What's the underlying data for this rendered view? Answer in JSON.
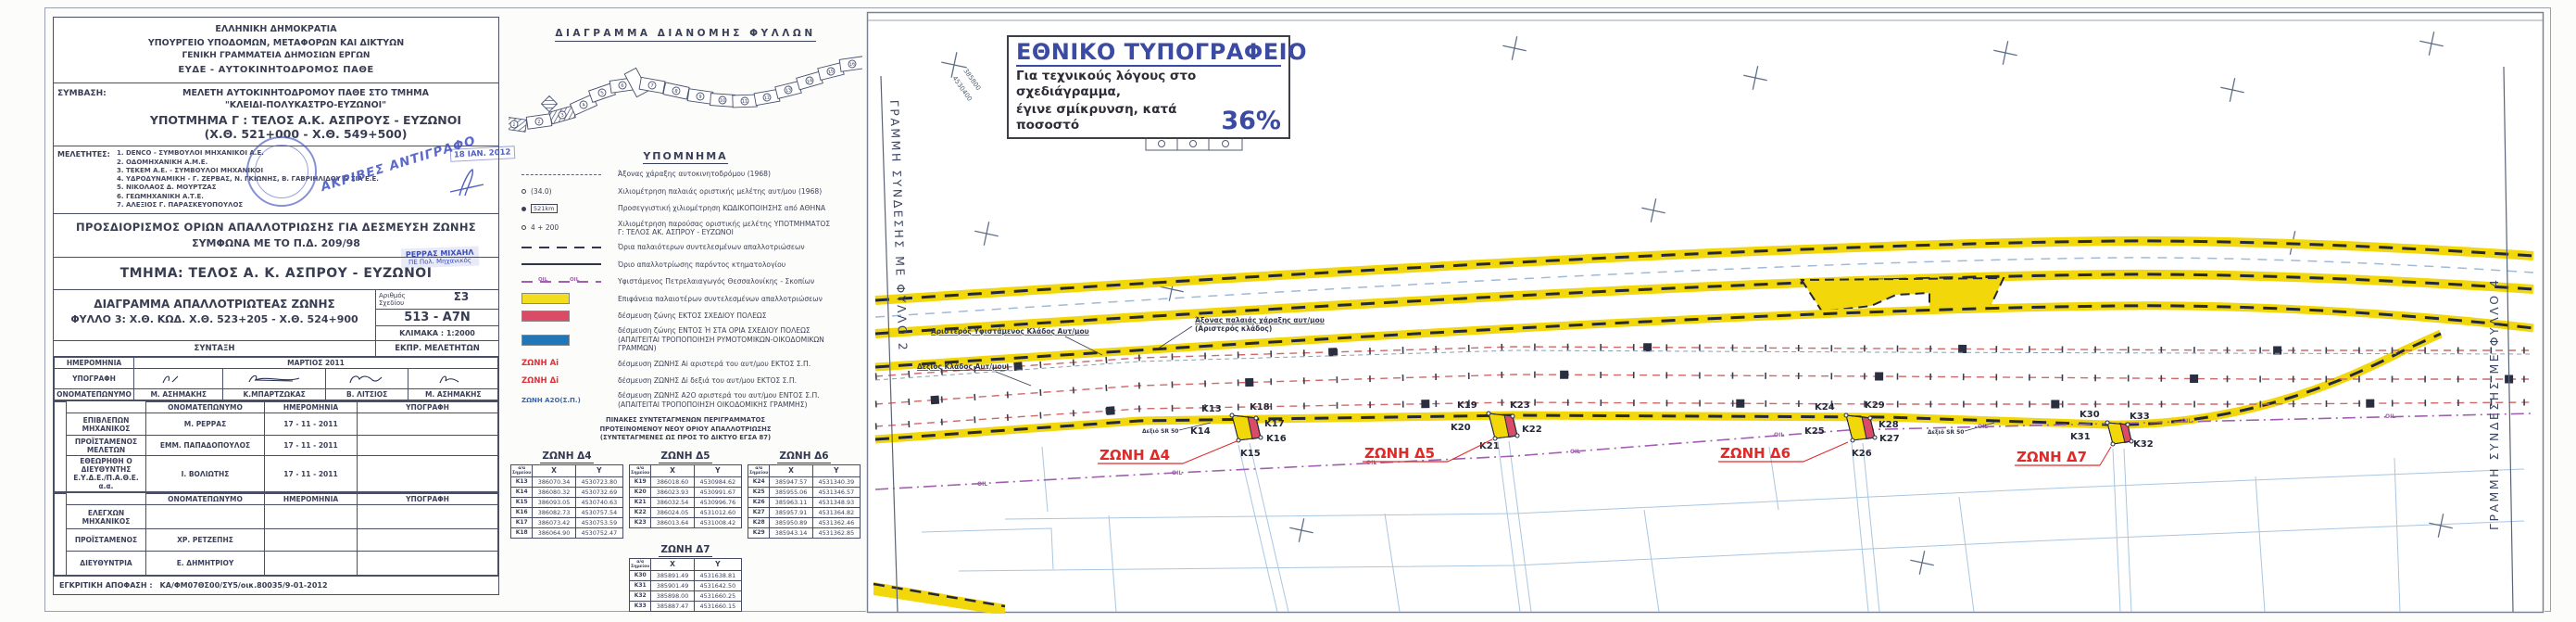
{
  "title_block": {
    "agency": [
      "ΕΛΛΗΝΙΚΗ ΔΗΜΟΚΡΑΤΙΑ",
      "ΥΠΟΥΡΓΕΙΟ ΥΠΟΔΟΜΩΝ, ΜΕΤΑΦΟΡΩΝ ΚΑΙ ΔΙΚΤΥΩΝ",
      "ΓΕΝΙΚΗ ΓΡΑΜΜΑΤΕΙΑ ΔΗΜΟΣΙΩΝ ΕΡΓΩΝ",
      "ΕΥΔΕ - ΑΥΤΟΚΙΝΗΤΟΔΡΟΜΟΣ ΠΑΘΕ"
    ],
    "symvasi_label": "ΣΥΜΒΑΣΗ:",
    "symvasi": [
      "ΜΕΛΕΤΗ ΑΥΤΟΚΙΝΗΤΟΔΡΟΜΟΥ ΠΑΘΕ ΣΤΟ ΤΜΗΜΑ",
      "\"ΚΛΕΙΔΙ-ΠΟΛΥΚΑΣΤΡΟ-ΕΥΖΩΝΟΙ\"",
      "ΥΠΟΤΜΗΜΑ Γ : ΤΕΛΟΣ Α.Κ. ΑΣΠΡΟΥΣ - ΕΥΖΩΝΟΙ",
      "(Χ.Θ. 521+000 - Χ.Θ. 549+500)"
    ],
    "meletites_label": "ΜΕΛΕΤΗΤΕΣ:",
    "meletites": [
      "1. DENCO - ΣΥΜΒΟΥΛΟΙ ΜΗΧΑΝΙΚΟΙ Α.Ε.",
      "2. ΟΔΟΜΗΧΑΝΙΚΗ Α.Μ.Ε.",
      "3. ΤΕΚΕΜ Α.Ε. - ΣΥΜΒΟΥΛΟΙ ΜΗΧΑΝΙΚΟΙ",
      "4. ΥΔΡΟΔΥΝΑΜΙΚΗ - Γ. ΖΕΡΒΑΣ, Ν. ΓΚΙΩΝΗΣ, Β. ΓΑΒΡΙΗΛΙΔΟΥ & ΣΙΑ Ε.Ε.",
      "5. ΝΙΚΟΛΑΟΣ Δ. ΜΟΥΡΤΖΑΣ",
      "6. ΓΕΩΜΗΧΑΝΙΚΗ Α.Τ.Ε.",
      "7. ΑΛΕΞΙΟΣ Γ. ΠΑΡΑΣΚΕΥΟΠΟΥΛΟΣ"
    ],
    "stamps": {
      "akrives": "ΑΚΡΙΒΕΣ ΑΝΤΙΓΡΑΦΟ",
      "date": "18 ΙΑΝ. 2012",
      "name": "ΡΕΡΡΑΣ ΜΙΧΑΗΛ",
      "title": "ΠΕ Πολ. Μηχανικός"
    },
    "prosdiorismos": [
      "ΠΡΟΣΔΙΟΡΙΣΜΟΣ ΟΡΙΩΝ ΑΠΑΛΛΟΤΡΙΩΣΗΣ ΓΙΑ ΔΕΣΜΕΥΣΗ ΖΩΝΗΣ",
      "ΣΥΜΦΩΝΑ ΜΕ ΤΟ Π.Δ. 209/98"
    ],
    "tmima": "ΤΜΗΜΑ: ΤΕΛΟΣ  Α. Κ. ΑΣΠΡΟΥ - ΕΥΖΩΝΟΙ",
    "drawing": {
      "title1": "ΔΙΑΓΡΑΜΜΑ ΑΠΑΛΛΟΤΡΙΩΤΕΑΣ ΖΩΝΗΣ",
      "title2": "ΦΥΛΛΟ  3: Χ.Θ. ΚΩΔ. Χ.Θ. 523+205 - Χ.Θ. 524+900",
      "no_label": "Αριθμός Σχεδίου",
      "no1": "Σ3",
      "no2": "513 - Α7Ν",
      "scale": "ΚΛΙΜΑΚΑ : 1:2000",
      "syntaxi": "ΣΥΝΤΑΞΗ",
      "ekpr": "ΕΚΠΡ. ΜΕΛΕΤΗΤΩΝ"
    },
    "t1": {
      "date_label": "ΗΜΕΡΟΜΗΝΙΑ",
      "date": "ΜΑΡΤΙΟΣ  2011",
      "sig_label": "ΥΠΟΓΡΑΦΗ",
      "name_label": "ΟΝΟΜΑΤΕΠΩΝΥΜΟ",
      "names": [
        "Μ. ΑΣΗΜΑΚΗΣ",
        "Κ.ΜΠΑΡΤΖΩΚΑΣ",
        "Β. ΛΙΤΣΙΟΣ",
        "Μ. ΑΣΗΜΑΚΗΣ"
      ]
    },
    "t2": {
      "h_name": "ΟΝΟΜΑΤΕΠΩΝΥΜΟ",
      "h_date": "ΗΜΕΡΟΜΗΝΙΑ",
      "h_sig": "ΥΠΟΓΡΑΦΗ",
      "rows": [
        {
          "role": "ΕΠΙΒΛΕΠΩΝ ΜΗΧΑΝΙΚΟΣ",
          "name": "Μ. ΡΕΡΡΑΣ",
          "date": "17 - 11 - 2011"
        },
        {
          "role": "ΠΡΟΪΣΤΑΜΕΝΟΣ ΜΕΛΕΤΩΝ",
          "name": "ΕΜΜ. ΠΑΠΑΔΟΠΟΥΛΟΣ",
          "date": "17 - 11 - 2011"
        },
        {
          "role": "ΕΘΕΩΡΗΘΗ Ο ΔΙΕΥΘΥΝΤΗΣ Ε.Υ.Δ.Ε./Π.Α.Θ.Ε. α.α.",
          "name": "Ι. ΒΟΛΙΩΤΗΣ",
          "date": "17 - 11 - 2011"
        }
      ]
    },
    "t3": {
      "h_name": "ΟΝΟΜΑΤΕΠΩΝΥΜΟ",
      "h_date": "ΗΜΕΡΟΜΗΝΙΑ",
      "h_sig": "ΥΠΟΓΡΑΦΗ",
      "rows": [
        {
          "role": "ΕΛΕΓΧΩΝ ΜΗΧΑΝΙΚΟΣ",
          "name": ""
        },
        {
          "role": "ΠΡΟΪΣΤΑΜΕΝΟΣ",
          "name": "ΧΡ. ΡΕΤΖΕΠΗΣ"
        },
        {
          "role": "ΔΙΕΥΘΥΝΤΡΙΑ",
          "name": "Ε. ΔΗΜΗΤΡΙΟΥ"
        }
      ]
    },
    "approval_label": "ΕΓΚΡΙΤΙΚΗ ΑΠΟΦΑΣΗ :",
    "approval": "ΚΑ/ΦΜ07ΘΣ00/ΣΥ5/οικ.80035/9-01-2012"
  },
  "sheet_index": {
    "title": "ΔΙΑΓΡΑΜΜΑ  ΔΙΑΝΟΜΗΣ  ΦΥΛΛΩΝ",
    "numbers": [
      "1",
      "2",
      "3",
      "4",
      "5",
      "6",
      "7",
      "8",
      "9",
      "10",
      "11",
      "12",
      "13",
      "14",
      "15",
      "16"
    ]
  },
  "legend": {
    "title": "ΥΠΟΜΝΗΜΑ",
    "items": [
      {
        "sym": "axis-dash",
        "label": "Άξονας χάραξης αυτοκινητοδρόμου (1968)"
      },
      {
        "sym": "km-old",
        "symtext": "(34.0)",
        "label": "Χιλιομέτρηση παλαιάς οριστικής μελέτης αυτ/μου (1968)"
      },
      {
        "sym": "km-code",
        "symtext": "521km",
        "label": "Προσεγγιστική χιλιομέτρηση ΚΩΔΙΚΟΠΟΙΗΣΗΣ από ΑΘΗΝΑ"
      },
      {
        "sym": "km-new",
        "symtext": "4 + 200",
        "label": "Χιλιομέτρηση παρούσας οριστικής μελέτης ΥΠΟΤΜΗΜΑΤΟΣ Γ: ΤΕΛΟΣ ΑΚ. ΑΣΠΡΟΥ - ΕΥΖΩΝΟΙ"
      },
      {
        "sym": "old-dash",
        "label": "Όρια παλαιότερων συντελεσμένων απαλλοτριώσεων"
      },
      {
        "sym": "solid",
        "label": "Όριο απαλλοτρίωσης παρόντος κτηματολογίου"
      },
      {
        "sym": "pipeline",
        "symtext": "OIL",
        "label": "Υφιστάμενος Πετρελαιαγωγός  Θεσσαλονίκης - Σκοπίων"
      },
      {
        "sym": "swatch-yellow",
        "label": "Επιφάνεια παλαιοτέρων συντελεσμένων απαλλοτριώσεων"
      },
      {
        "sym": "swatch-red",
        "label": "δέσμευση ζώνης ΕΚΤΟΣ ΣΧΕΔΙΟΥ ΠΟΛΕΩΣ"
      },
      {
        "sym": "swatch-blue",
        "label": "δέσμευση ζώνης ΕΝΤΟΣ Ή ΣΤΑ ΟΡΙΑ ΣΧΕΔΙΟΥ ΠΟΛΕΩΣ (ΑΠΑΙΤΕΙΤΑΙ ΤΡΟΠΟΠΟΙΗΣΗ ΡΥΜΟΤΟΜΙΚΩΝ-ΟΙΚΟΔΟΜΙΚΩΝ ΓΡΑΜΜΩΝ)"
      },
      {
        "sym": "zone-red",
        "symtext": "ΖΩΝΗ Αi",
        "label": "δέσμευση ΖΩΝΗΣ Αi αριστερά του αυτ/μου ΕΚΤΟΣ Σ.Π."
      },
      {
        "sym": "zone-red",
        "symtext": "ΖΩΝΗ Δi",
        "label": "δέσμευση ΖΩΝΗΣ Δi δεξιά του αυτ/μου ΕΚΤΟΣ Σ.Π."
      },
      {
        "sym": "zone-blue",
        "symtext": "ΖΩΝΗ Α2Ο(Σ.Π.)",
        "label": "δέσμευση ΖΩΝΗΣ Α2Ο αριστερά του αυτ/μου ΕΝΤΟΣ Σ.Π. (ΑΠΑΙΤΕΙΤΑΙ ΤΡΟΠΟΠΟΙΗΣΗ ΟΙΚΟΔΟΜΙΚΗΣ ΓΡΑΜΜΗΣ)"
      }
    ]
  },
  "coord_note": [
    "ΠΙΝΑΚΕΣ ΣΥΝΤΕΤΑΓΜΕΝΩΝ ΠΕΡΙΓΡΑΜΜΑΤΟΣ",
    "ΠΡΟΤΕΙΝΟΜΕΝΟΥ ΝΕΟΥ ΟΡΙΟΥ ΑΠΑΛΛΟΤΡΙΩΣΗΣ",
    "(ΣΥΝΤΕΤΑΓΜΕΝΕΣ ΩΣ ΠΡΟΣ ΤΟ ΔΙΚΤΥΟ ΕΓΣΑ 87)"
  ],
  "zones": [
    {
      "name": "ΖΩΝΗ Δ4",
      "h": {
        "pt": "α/α Σημείου",
        "x": "X",
        "y": "Y"
      },
      "rows": [
        [
          "K13",
          "386070.34",
          "4530723.80"
        ],
        [
          "K14",
          "386080.32",
          "4530732.69"
        ],
        [
          "K15",
          "386093.05",
          "4530740.63"
        ],
        [
          "K16",
          "386082.73",
          "4530757.54"
        ],
        [
          "K17",
          "386073.42",
          "4530753.59"
        ],
        [
          "K18",
          "386064.90",
          "4530752.47"
        ]
      ]
    },
    {
      "name": "ΖΩΝΗ Δ5",
      "h": {
        "pt": "α/α Σημείου",
        "x": "X",
        "y": "Y"
      },
      "rows": [
        [
          "K19",
          "386018.60",
          "4530984.62"
        ],
        [
          "K20",
          "386023.93",
          "4530991.67"
        ],
        [
          "K21",
          "386032.54",
          "4530996.76"
        ],
        [
          "K22",
          "386024.05",
          "4531012.60"
        ],
        [
          "K23",
          "386013.64",
          "4531008.42"
        ]
      ]
    },
    {
      "name": "ΖΩΝΗ Δ6",
      "h": {
        "pt": "α/α Σημείου",
        "x": "X",
        "y": "Y"
      },
      "rows": [
        [
          "K24",
          "385947.57",
          "4531340.39"
        ],
        [
          "K25",
          "385955.06",
          "4531346.57"
        ],
        [
          "K26",
          "385963.11",
          "4531348.93"
        ],
        [
          "K27",
          "385957.91",
          "4531364.82"
        ],
        [
          "K28",
          "385950.89",
          "4531362.46"
        ],
        [
          "K29",
          "385943.14",
          "4531362.85"
        ]
      ]
    },
    {
      "name": "ΖΩΝΗ Δ7",
      "h": {
        "pt": "α/α Σημείου",
        "x": "X",
        "y": "Y"
      },
      "rows": [
        [
          "K30",
          "385891.49",
          "4531638.81"
        ],
        [
          "K31",
          "385901.49",
          "4531642.50"
        ],
        [
          "K32",
          "385898.00",
          "4531660.25"
        ],
        [
          "K33",
          "385887.47",
          "4531660.15"
        ]
      ]
    }
  ],
  "map": {
    "ethniko": {
      "title": "ΕΘΝΙΚΟ ΤΥΠΟΓΡΑΦΕΙΟ",
      "line1": "Για τεχνικούς λόγους στο σχεδιάγραμμα,",
      "line2": "έγινε σμίκρυνση, κατά ποσοστό",
      "pct": "36%"
    },
    "edge_left": "ΓΡΑΜΜΗ ΣΥΝΔΕΣΗΣ ΜΕ ΦΥΛΛΟ 2",
    "edge_right": "ΓΡΑΜΜΗ ΣΥΝΔΕΣΗΣ ΜΕ ΦΥΛΛΟ 4",
    "labels": {
      "left_branch": "Αριστερός Υφιστάμενος Κλάδος Αυτ/μου",
      "right_branch": "Δεξιός Κλάδος Αυτ/μου",
      "old_axis1": "Άξονας παλαιάς χάραξης αυτ/μου",
      "old_axis2": "(Αριστερός κλάδος)",
      "sr": "Δεξιό SR 50",
      "oil": "OIL"
    },
    "zone_labels": [
      "ΖΩΝΗ  Δ4",
      "ΖΩΝΗ  Δ5",
      "ΖΩΝΗ  Δ6",
      "ΖΩΝΗ  Δ7"
    ],
    "kpoints": [
      "K13",
      "K14",
      "K15",
      "K16",
      "K17",
      "K18",
      "K19",
      "K20",
      "K21",
      "K22",
      "K23",
      "K24",
      "K25",
      "K26",
      "K27",
      "K28",
      "K29",
      "K30",
      "K31",
      "K32",
      "K33"
    ],
    "grid": {
      "x": "385800",
      "y": "4530400"
    }
  }
}
